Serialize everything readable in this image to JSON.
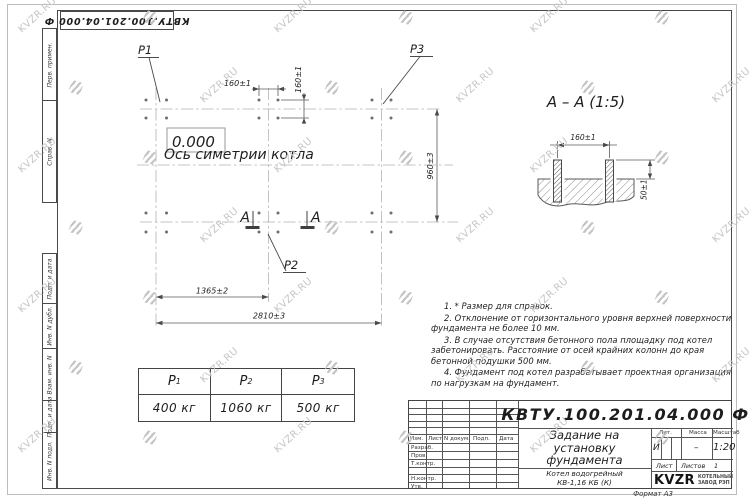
{
  "colors": {
    "watermark": "#c6c6ca",
    "line": "#4a4a4a",
    "logo_black": "#141414"
  },
  "watermark": {
    "text": "KVZR.RU"
  },
  "corner_stamp": {
    "designation_rotated": "КВТУ.100.201.04.000  Ф"
  },
  "sidebar": {
    "labels": [
      "Перв. примен.",
      "Справ. N",
      "Подп. и дата",
      "Инв. N дубл.",
      "Взам. инв. N",
      "Подп. и дата",
      "Инв. N подл."
    ]
  },
  "plan": {
    "p1": "P1",
    "p2": "P2",
    "p3": "P3",
    "elevation": "0.000",
    "axis_label": "Ось симетрии котла",
    "dim_160_h": "160±1",
    "dim_160_v": "160±1",
    "dim_960": "960±3",
    "dim_1365": "1365±2",
    "dim_2810": "2810±3",
    "section_letter_left": "A",
    "section_letter_right": "A"
  },
  "section": {
    "title": "A – A (1:5)",
    "dim_160": "160±1",
    "dim_50": "50±1"
  },
  "load_table": {
    "headers": [
      {
        "letter": "P",
        "sub": "1"
      },
      {
        "letter": "P",
        "sub": "2"
      },
      {
        "letter": "P",
        "sub": "3"
      }
    ],
    "values": [
      "400 кг",
      "1060 кг",
      "500 кг"
    ]
  },
  "notes": {
    "items": [
      "1.  * Размер для справок.",
      "2.  Отклонение от горизонтального уровня верхней поверхности фундамента не более 10 мм.",
      "3.  В случае отсутствия бетонного пола площадку под котел забетонировать. Расстояние от осей крайних колонн до края бетонной подушки 500 мм.",
      "4.  Фундамент под котел разрабатывает проектная организация по нагрузкам на фундамент."
    ]
  },
  "title_block": {
    "designation": "КВТУ.100.201.04.000  Ф",
    "doc_title_lines": [
      "Задание на",
      "установку",
      "фундамента"
    ],
    "product_lines": [
      "Котел водогрейный",
      "КВ-1,16 КБ  (К)"
    ],
    "header_cols": [
      "Изм.",
      "Лист",
      "N докум.",
      "Подп.",
      "Дата"
    ],
    "row_labels": [
      "Разраб.",
      "Пров.",
      "Т.контр.",
      "Н.контр.",
      "Утв."
    ],
    "lit_label": "Лит.",
    "mass_label": "Масса",
    "scale_label": "Масштаб",
    "lit_value": "И",
    "mass_value": "–",
    "scale_value": "1:20",
    "sheet_label": "Лист",
    "sheets_label": "Листов",
    "sheets_value": "1",
    "format_label": "Формат А3",
    "logo": {
      "name": "KVZR",
      "tagline_lines": [
        "КОТЕЛЬНЫЙ",
        "ЗАВОД РЭП"
      ]
    }
  }
}
